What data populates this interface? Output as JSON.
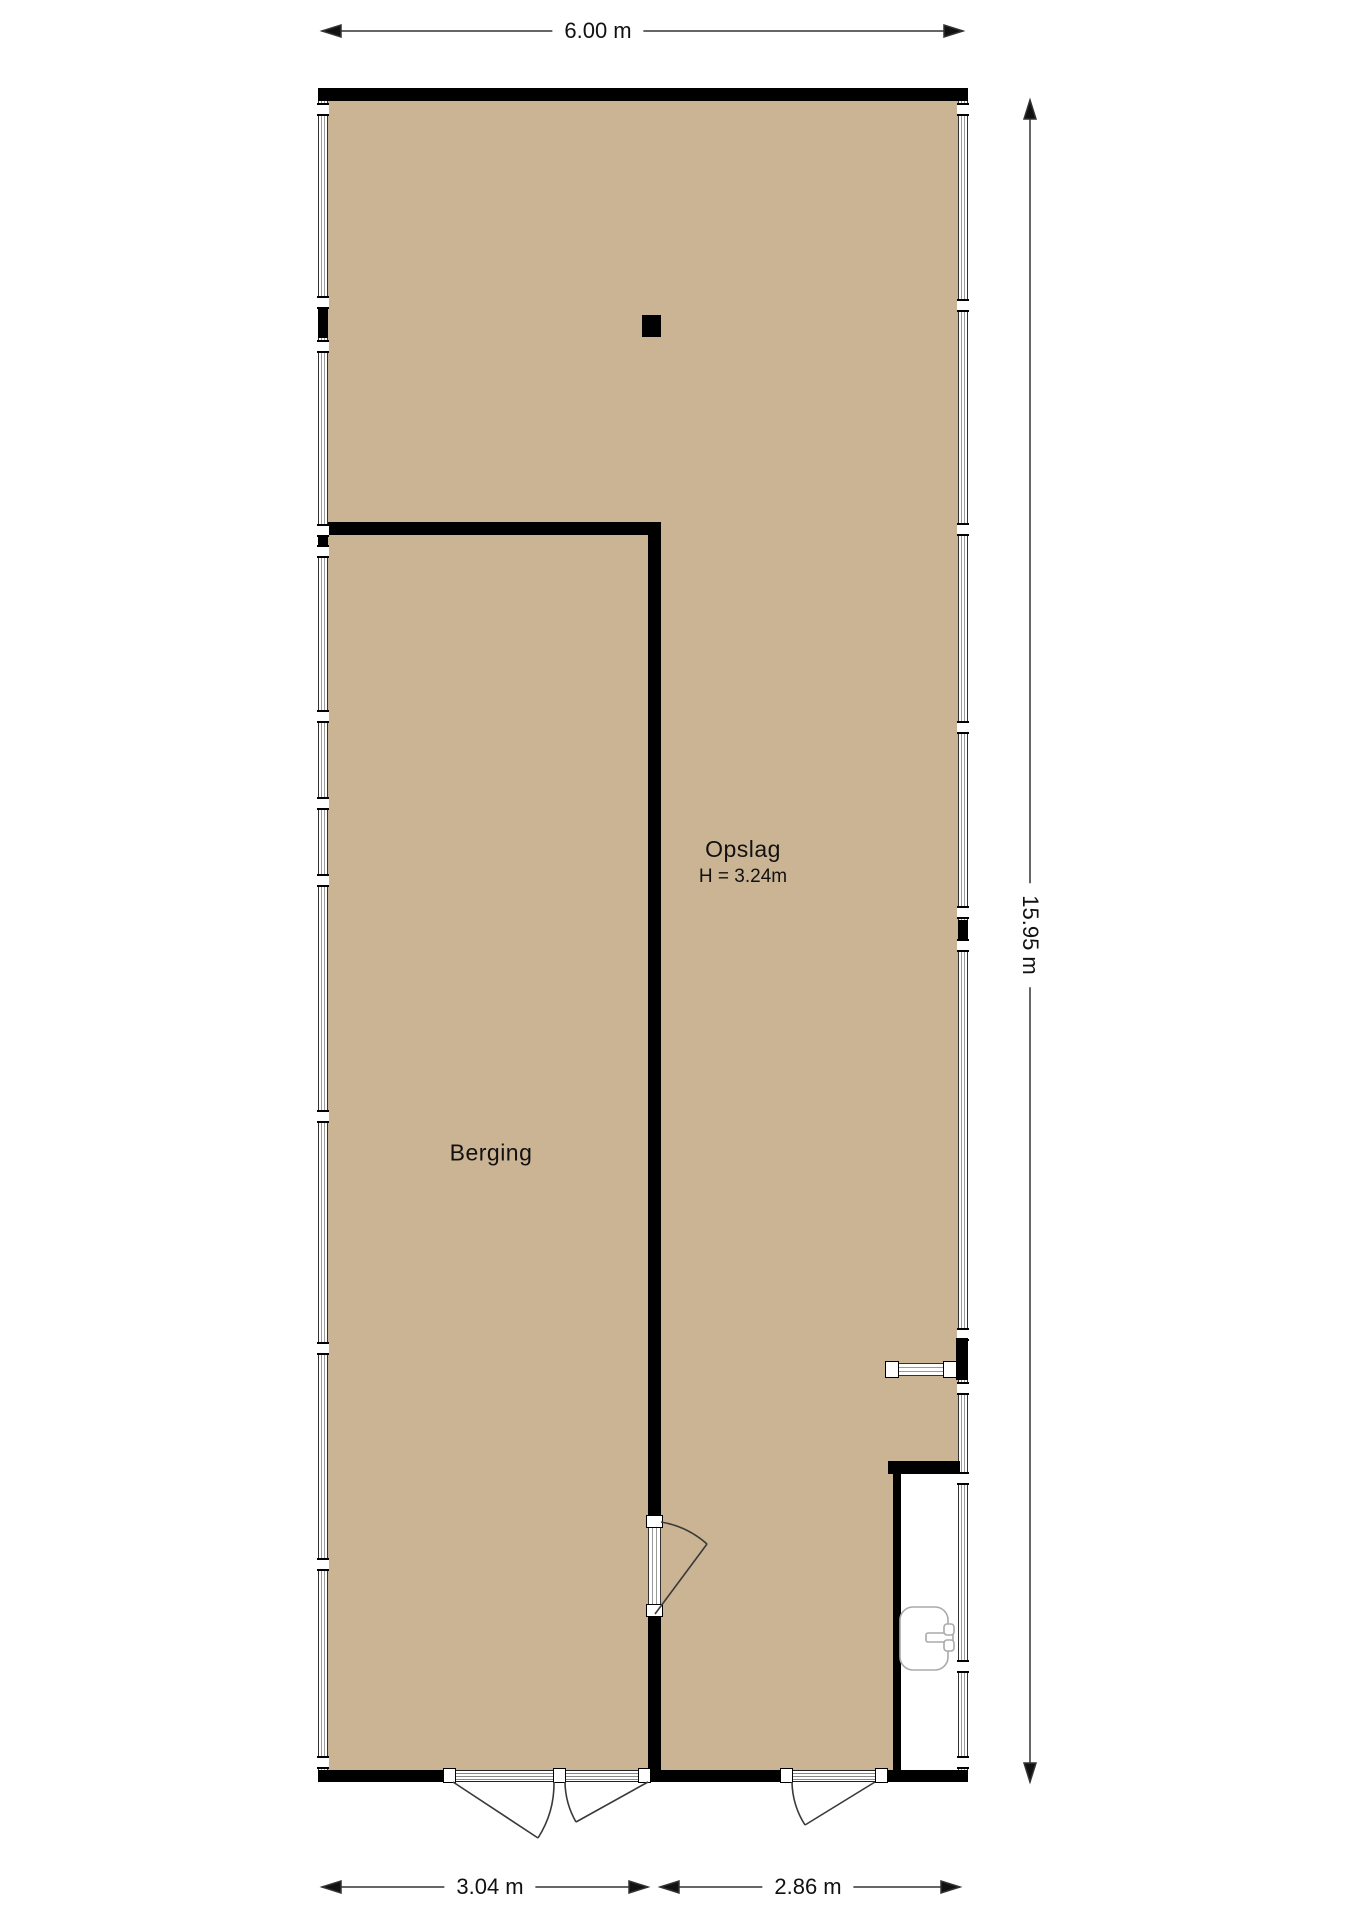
{
  "plan": {
    "rooms": {
      "opslag": {
        "name": "Opslag",
        "height_label": "H = 3.24m"
      },
      "berging": {
        "name": "Berging"
      }
    },
    "dimensions": {
      "top": "6.00 m",
      "right": "15.95 m",
      "bottom_left": "3.04 m",
      "bottom_right": "2.86 m"
    },
    "colors": {
      "floor": "#cbb494",
      "wall": "#000000",
      "dimension_line": "#333333",
      "door_swing": "#3a3a3a",
      "fixture_outline": "#aaaaaa"
    },
    "fixtures": [
      "sink"
    ]
  }
}
